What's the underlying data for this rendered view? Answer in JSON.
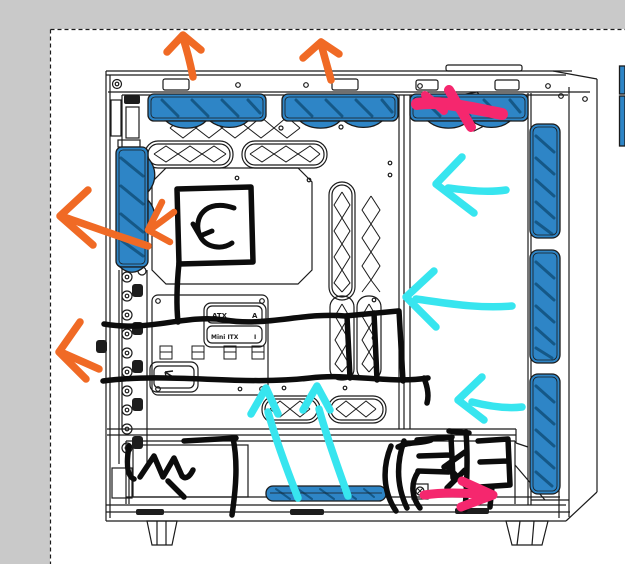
{
  "window": {
    "workspace_color": "#c9c9c9"
  },
  "canvas": {
    "surface_color": "#ffffff"
  },
  "selection_marquee": {
    "dash_color": "#1a1a1a"
  },
  "colors": {
    "line": "#1b1b1b",
    "ink_dark": "#1d1d1d",
    "fan_blue": "#2e85c6",
    "fan_shade": "#155887",
    "marker_black": "#0c0c0c",
    "marker_orange": "#f06a25",
    "marker_cyan": "#37e5ef",
    "marker_pink": "#f5276e"
  },
  "drawing": {
    "subject": "pc-case-side-view-line-art",
    "labels": {
      "atx": "ATX",
      "atx_key": "A",
      "itx": "Mini ITX",
      "itx_key": "I"
    }
  },
  "annotations": {
    "orange_arrows": [
      "up-exhaust-top-left",
      "up-exhaust-top-mid",
      "left-exhaust-rear-upper",
      "left-exhaust-at-rear-fan",
      "left-exhaust-rear-lower"
    ],
    "cyan_arrows": [
      "left-intake-front-upper",
      "left-intake-front-middle",
      "left-intake-front-lower",
      "up-intake-bottom-left",
      "up-intake-bottom-right"
    ],
    "pink_marks": [
      "cross-top-front",
      "arrow-right-bottom"
    ],
    "black_marks": [
      "square-cpu-area",
      "curved-arrow-in-square",
      "cable-line-upper",
      "cable-line-lower",
      "box-over-center-vents",
      "scribble-bottom-left",
      "scribble-bottom-right"
    ]
  }
}
